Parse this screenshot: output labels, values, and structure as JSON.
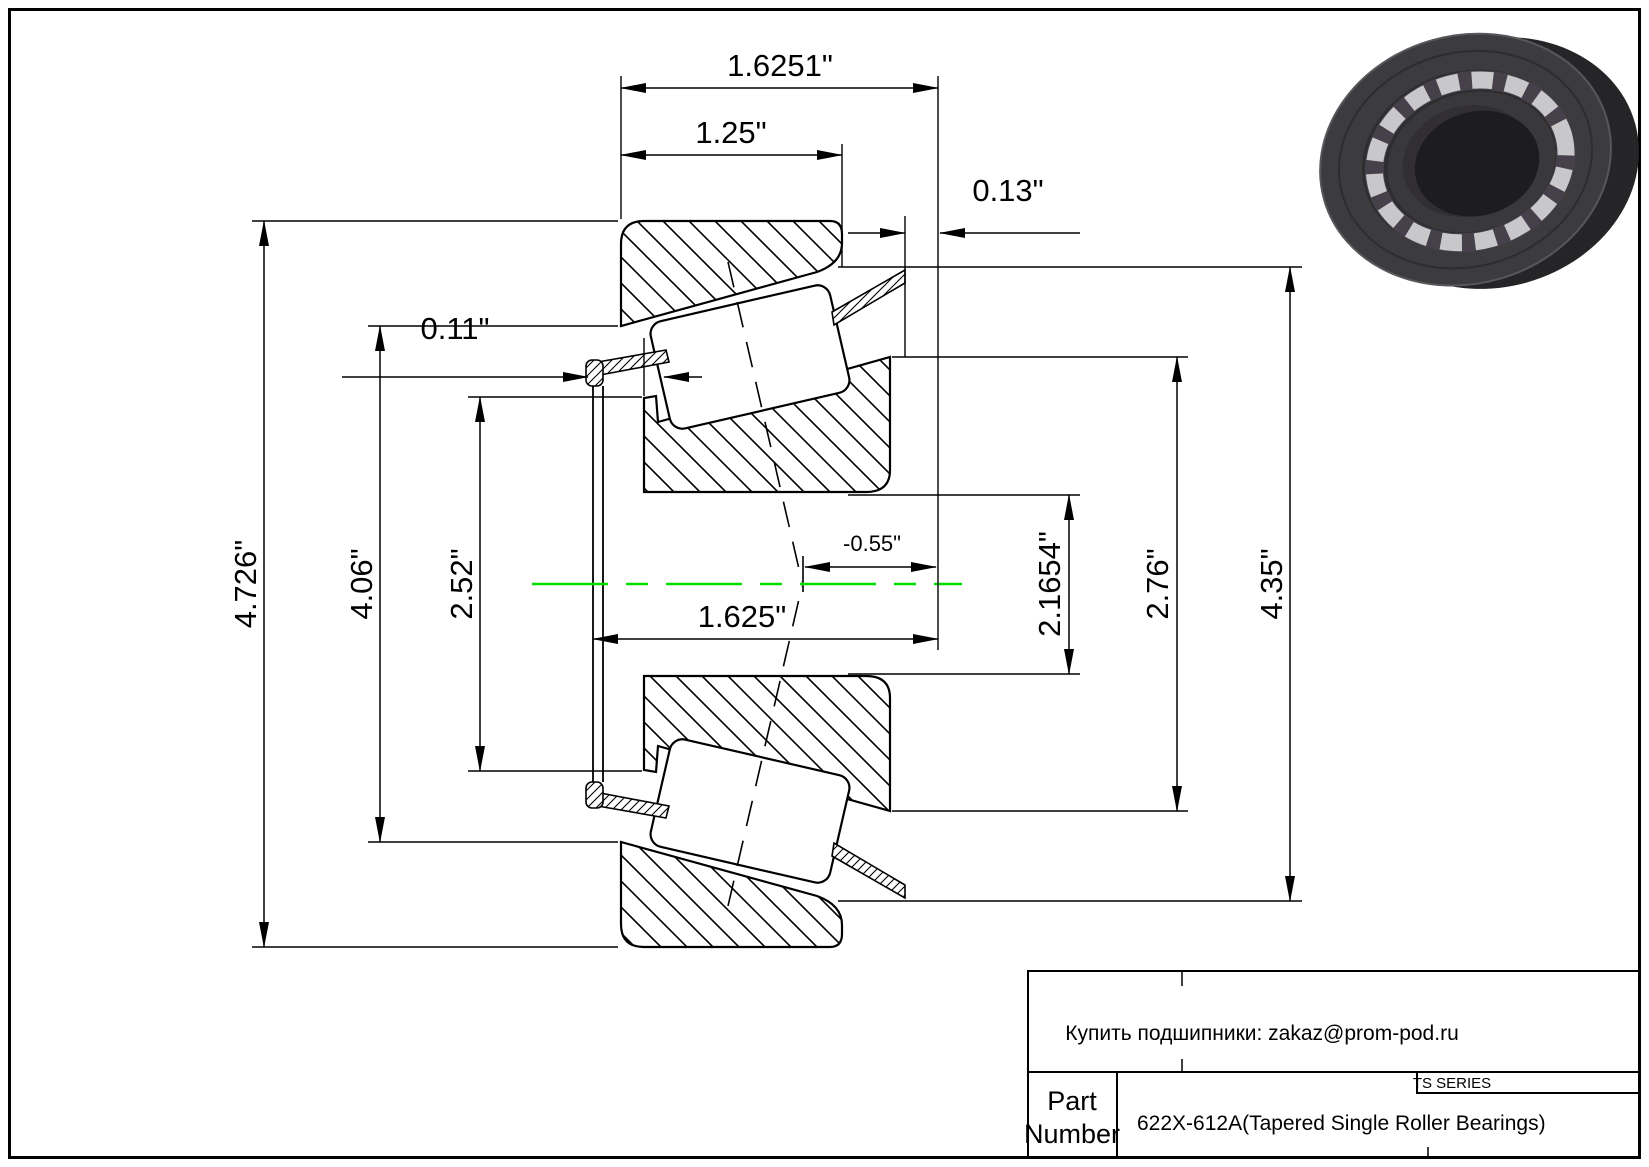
{
  "page": {
    "background": "#ffffff",
    "border_color": "#000000"
  },
  "drawing": {
    "centerline_color": "#00dd00",
    "dimensions": {
      "overall_width": "1.6251\"",
      "cone_width": "1.25\"",
      "cup_back_offset": "0.13\"",
      "cage_front_offset": "0.11\"",
      "bore_width": "1.625\"",
      "effective_center": "-0.55\"",
      "outer_diameter": "4.726\"",
      "cup_front_diameter": "4.06\"",
      "cone_front_diameter": "2.52\"",
      "cone_back_diameter": "2.1654\"",
      "rib_diameter": "2.76\"",
      "cup_outer_diameter": "4.35\""
    }
  },
  "title_block": {
    "email_line": "Купить подшипники: zakaz@prom-pod.ru",
    "series_label": "TS SERIES",
    "part_label_line1": "Part",
    "part_label_line2": "Number",
    "part_value": "622X-612A(Tapered Single Roller Bearings)"
  }
}
